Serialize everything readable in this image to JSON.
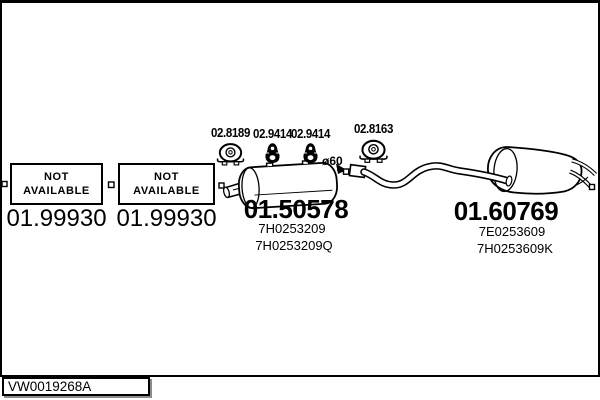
{
  "diagram": {
    "not_available": {
      "line1": "NOT",
      "line2": "AVAILABLE"
    },
    "front_parts": [
      {
        "code": "01.99930"
      },
      {
        "code": "01.99930"
      }
    ],
    "mounting_parts": [
      {
        "code": "02.8189",
        "icon": "pipe-clamp-icon"
      },
      {
        "code": "02.9414",
        "icon": "rubber-hanger-icon"
      },
      {
        "code": "02.9414",
        "icon": "rubber-hanger-icon"
      },
      {
        "code": "02.8163",
        "icon": "pipe-clamp-icon"
      }
    ],
    "diameter_label": "ø60",
    "centre_muffler": {
      "code": "01.50578",
      "oem_numbers": [
        "7H0253209",
        "7H0253209Q"
      ]
    },
    "rear_muffler": {
      "code": "01.60769",
      "oem_numbers": [
        "7E0253609",
        "7H0253609K"
      ]
    },
    "drawing_number": "VW0019268A",
    "colors": {
      "line": "#000000",
      "background": "#ffffff"
    }
  }
}
